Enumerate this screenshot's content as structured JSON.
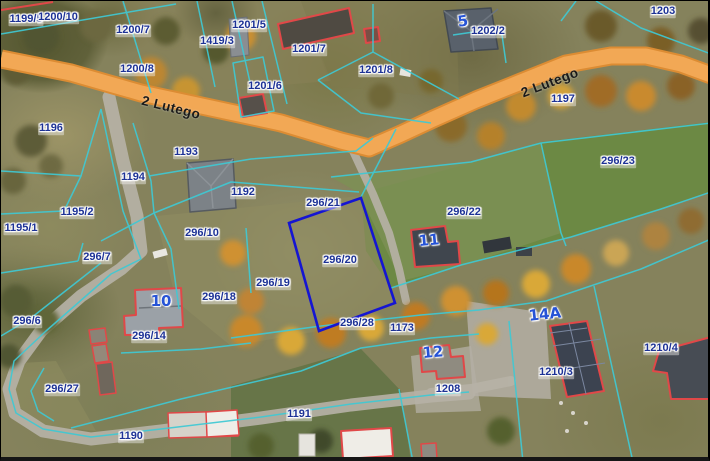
{
  "map": {
    "description": "Aerial orthophoto cadastral map with parcel boundaries",
    "street_name": "2 Lutego",
    "highlighted_parcel": "296/20",
    "colors": {
      "cadastral_line": "#3fc9d4",
      "selected_parcel_outline": "#1515d2",
      "building_outline": "#e04848",
      "road_fill": "#f2a855",
      "road_edge": "#dc8c33",
      "parcel_label": "#1d3296",
      "address_label": "#2653d6",
      "street_label": "#1a1a1a"
    },
    "street_labels": [
      {
        "text": "2 Lutego",
        "x": 170,
        "y": 107,
        "rot": 14
      },
      {
        "text": "2 Lutego",
        "x": 549,
        "y": 82,
        "rot": -21
      }
    ],
    "parcel_labels": [
      {
        "text": "1199/5",
        "x": 25,
        "y": 19
      },
      {
        "text": "1200/10",
        "x": 57,
        "y": 17
      },
      {
        "text": "1200/7",
        "x": 132,
        "y": 30
      },
      {
        "text": "1419/3",
        "x": 216,
        "y": 41
      },
      {
        "text": "1200/8",
        "x": 136,
        "y": 69
      },
      {
        "text": "1201/5",
        "x": 248,
        "y": 25
      },
      {
        "text": "1201/7",
        "x": 308,
        "y": 49
      },
      {
        "text": "1201/6",
        "x": 264,
        "y": 86
      },
      {
        "text": "1201/8",
        "x": 375,
        "y": 70
      },
      {
        "text": "1202/2",
        "x": 487,
        "y": 31
      },
      {
        "text": "1203",
        "x": 662,
        "y": 11
      },
      {
        "text": "1197",
        "x": 562,
        "y": 99
      },
      {
        "text": "1196",
        "x": 50,
        "y": 128
      },
      {
        "text": "1193",
        "x": 185,
        "y": 152
      },
      {
        "text": "1194",
        "x": 132,
        "y": 177
      },
      {
        "text": "1192",
        "x": 242,
        "y": 192
      },
      {
        "text": "1195/2",
        "x": 76,
        "y": 212
      },
      {
        "text": "1195/1",
        "x": 20,
        "y": 228
      },
      {
        "text": "296/10",
        "x": 201,
        "y": 233
      },
      {
        "text": "296/21",
        "x": 322,
        "y": 203
      },
      {
        "text": "296/22",
        "x": 463,
        "y": 212
      },
      {
        "text": "296/23",
        "x": 617,
        "y": 161
      },
      {
        "text": "296/20",
        "x": 339,
        "y": 260
      },
      {
        "text": "296/7",
        "x": 96,
        "y": 257
      },
      {
        "text": "296/6",
        "x": 26,
        "y": 321
      },
      {
        "text": "296/18",
        "x": 218,
        "y": 297
      },
      {
        "text": "296/19",
        "x": 272,
        "y": 283
      },
      {
        "text": "296/14",
        "x": 148,
        "y": 336
      },
      {
        "text": "296/28",
        "x": 356,
        "y": 323
      },
      {
        "text": "1173",
        "x": 401,
        "y": 328
      },
      {
        "text": "296/27",
        "x": 61,
        "y": 389
      },
      {
        "text": "1190",
        "x": 130,
        "y": 436
      },
      {
        "text": "1191",
        "x": 298,
        "y": 414
      },
      {
        "text": "1208",
        "x": 447,
        "y": 389
      },
      {
        "text": "1210/3",
        "x": 555,
        "y": 372
      },
      {
        "text": "1210/4",
        "x": 660,
        "y": 348
      }
    ],
    "address_labels": [
      {
        "text": "5",
        "x": 462,
        "y": 21,
        "rot": -8
      },
      {
        "text": "10",
        "x": 160,
        "y": 301,
        "rot": 0
      },
      {
        "text": "11",
        "x": 428,
        "y": 240,
        "rot": -5
      },
      {
        "text": "12",
        "x": 432,
        "y": 352,
        "rot": -5
      },
      {
        "text": "14A",
        "x": 544,
        "y": 314,
        "rot": -6
      }
    ]
  }
}
